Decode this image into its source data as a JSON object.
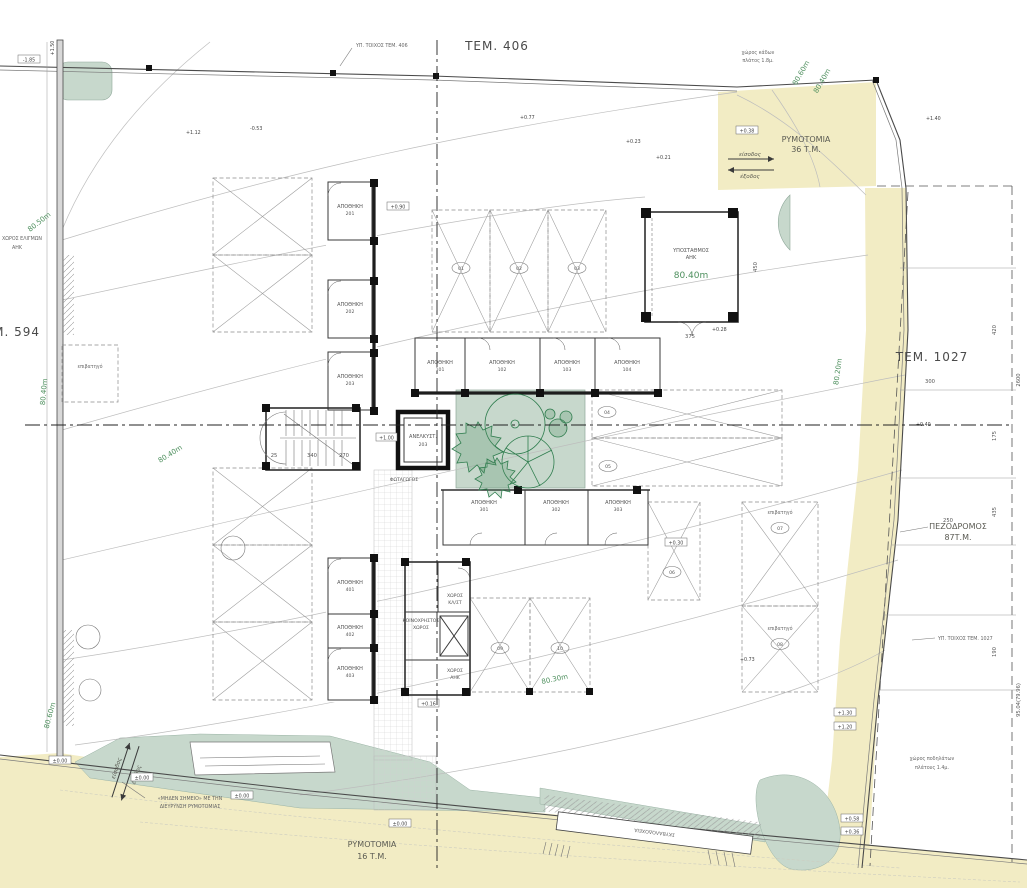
{
  "drawing": {
    "parcels": {
      "top": "ΤΕΜ. 406",
      "right": "ΤΕΜ. 1027",
      "left": "ΤΕΜ. 594"
    },
    "zones": {
      "rymotomia_top": {
        "name": "ΡΥΜΟΤΟΜΙΑ",
        "area": "36 Τ.Μ."
      },
      "rymotomia_bottom": {
        "name": "ΡΥΜΟΤΟΜΙΑ",
        "area": "16 Τ.Μ."
      },
      "pezodromos": {
        "name": "ΠΕΖΟΔΡΟΜΟΣ",
        "area": "87Τ.Μ."
      }
    },
    "access": {
      "entry": "είσοδος",
      "exit": "έξοδος"
    },
    "buildings": {
      "substation": {
        "line1": "ΥΠΟΣΤΑΘΜΟΣ",
        "line2": "ΑΗΚ"
      },
      "elevator": {
        "name": "ΑΝΕΛΚΥΣΤ.",
        "num": "203"
      },
      "lightwell": "ΦΩΤΑΓΩΓΟΣ",
      "common": {
        "line1": "ΚΟΙΝΟΧΡΗΣΤΟΣ",
        "line2": "ΧΩΡΟΣ"
      },
      "mech": {
        "line1": "ΧΩΡΟΣ",
        "line2": "ΚΛ/ΣΤ"
      },
      "ahk": {
        "line1": "ΧΩΡΟΣ",
        "line2": "ΑΗΚ"
      },
      "bins": "ΣΚΥΒΑΛΟΔΟΧΕΙΑ"
    },
    "rooms": {
      "block_nw": [
        {
          "name": "ΑΠΟΘΗΚΗ",
          "num": "201"
        },
        {
          "name": "ΑΠΟΘΗΚΗ",
          "num": "202"
        },
        {
          "name": "ΑΠΟΘΗΚΗ",
          "num": "203"
        }
      ],
      "row_mid": [
        {
          "name": "ΑΠΟΘΗΚΗ",
          "num": "101"
        },
        {
          "name": "ΑΠΟΘΗΚΗ",
          "num": "102"
        },
        {
          "name": "ΑΠΟΘΗΚΗ",
          "num": "103"
        },
        {
          "name": "ΑΠΟΘΗΚΗ",
          "num": "104"
        }
      ],
      "row_court": [
        {
          "name": "ΑΠΟΘΗΚΗ",
          "num": "301"
        },
        {
          "name": "ΑΠΟΘΗΚΗ",
          "num": "302"
        },
        {
          "name": "ΑΠΟΘΗΚΗ",
          "num": "303"
        }
      ],
      "block_sw": [
        {
          "name": "ΑΠΟΘΗΚΗ",
          "num": "401"
        },
        {
          "name": "ΑΠΟΘΗΚΗ",
          "num": "402"
        },
        {
          "name": "ΑΠΟΘΗΚΗ",
          "num": "403"
        }
      ]
    },
    "contours": {
      "c60": "80.60m",
      "c50": "80.50m",
      "c40": "80.40m",
      "c30": "80.30m",
      "c20": "80.20m"
    },
    "levels": {
      "m185": "-1.85",
      "p150": "+1.50",
      "zero": "±0.00",
      "p038": "+0.38",
      "p023": "+0.23",
      "p021": "+0.21",
      "p077": "+0.77",
      "m053": "-0.53",
      "p112": "+1.12",
      "p090": "+0.90",
      "p100": "+1.00",
      "p028": "+0.28",
      "p040": "+0.40",
      "p140": "+1.40",
      "p030": "+0.30",
      "p073": "+0.73",
      "p016": "+0.16",
      "p130": "+1.30",
      "p120": "+1.20",
      "p058": "+0.58",
      "p036": "+0.36"
    },
    "dims": {
      "d25": "25",
      "d340": "340",
      "d270": "270",
      "d450": "450",
      "d375": "375",
      "d300": "300",
      "d250": "250",
      "d420": "420",
      "d175": "175",
      "d435": "435",
      "d190": "190",
      "d2600": "2600",
      "total": "95.04(79.96)"
    },
    "notes": {
      "top_wall": "ΥΠ. ΤΟΙΧΟΣ ΤΕΜ. 406",
      "right_wall": "ΥΠ. ΤΟΙΧΟΣ ΤΕΜ. 1027",
      "zero1": "«ΜΗΔΕΝ ΣΗΜΕΙΟ» ΜΕ ΤΗΝ",
      "zero2": "ΔΙΕΥΡΥΝΣΗ ΡΥΜΟΤΟΜΙΑΣ",
      "maneuver1": "ΧΩΡΟΣ ΕΛΙΓΜΩΝ",
      "maneuver2": "ΑΗΚ",
      "binsnote1": "χώρος κάδων",
      "binsnote2": "πλάτος 1.8μ.",
      "bike1": "χώρος ποδηλάτων",
      "bike2": "πλάτους 1.4μ."
    },
    "parking": {
      "type": "επιβατηγό",
      "stalls": {
        "s01": "01",
        "s02": "02",
        "s03": "03",
        "s04": "04",
        "s05": "05",
        "s06": "06",
        "s07": "07",
        "s08": "08",
        "s09": "09",
        "s10": "10"
      }
    },
    "colors": {
      "paper": "#ffffff",
      "road_zone": "#f2ecc4",
      "green_zone": "#c7d8cc",
      "contour_label": "#4d8f5d",
      "tree": "#2f7d4e",
      "ink": "#333333",
      "contour_line": "#bdbdbd",
      "dim": "#555555"
    }
  }
}
